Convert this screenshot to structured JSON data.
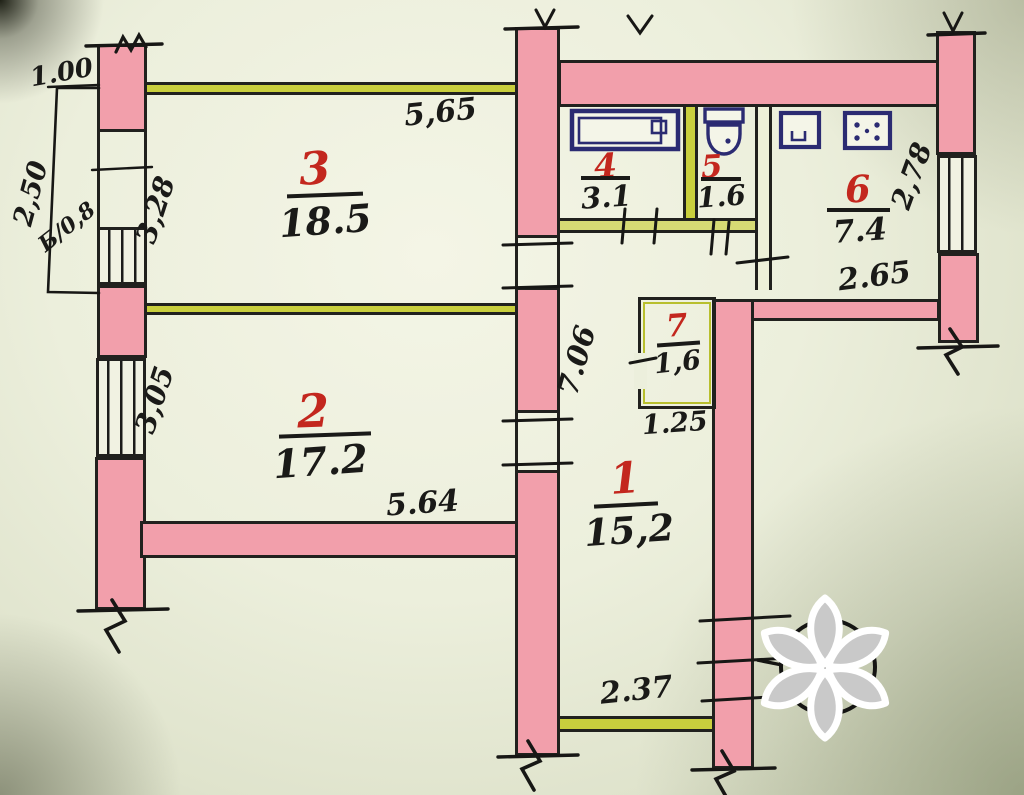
{
  "plan": {
    "title": "apartment-floor-plan",
    "rooms": [
      {
        "number": "1",
        "area": "15,2"
      },
      {
        "number": "2",
        "area": "17.2"
      },
      {
        "number": "3",
        "area": "18.5"
      },
      {
        "number": "4",
        "area": "3.1"
      },
      {
        "number": "5",
        "area": "1.6"
      },
      {
        "number": "6",
        "area": "7.4"
      },
      {
        "number": "7",
        "area": "1,6"
      }
    ],
    "dimensions": {
      "balcony_width": "1.00",
      "balcony_depth": "2,50",
      "balcony_label": "Б/0,8",
      "room3_left": "3,28",
      "room3_top": "5,65",
      "room2_left": "3,05",
      "room2_bottom": "5.64",
      "hall_left": "7.06",
      "entry_bottom": "2.37",
      "room7_bottom": "1.25",
      "kitchen_right": "2,78",
      "kitchen_bottom": "2.65"
    },
    "colors": {
      "wall_fill": "#f29fab",
      "partition_fill": "#c9cf3d",
      "ink": "#1a1a18",
      "room_number_ink": "#c3271e",
      "fixture_ink": "#2b2b72",
      "paper": "#ecefdc"
    }
  },
  "watermark": {
    "shape": "six-petal-asterisk",
    "outline": "#ffffff"
  }
}
